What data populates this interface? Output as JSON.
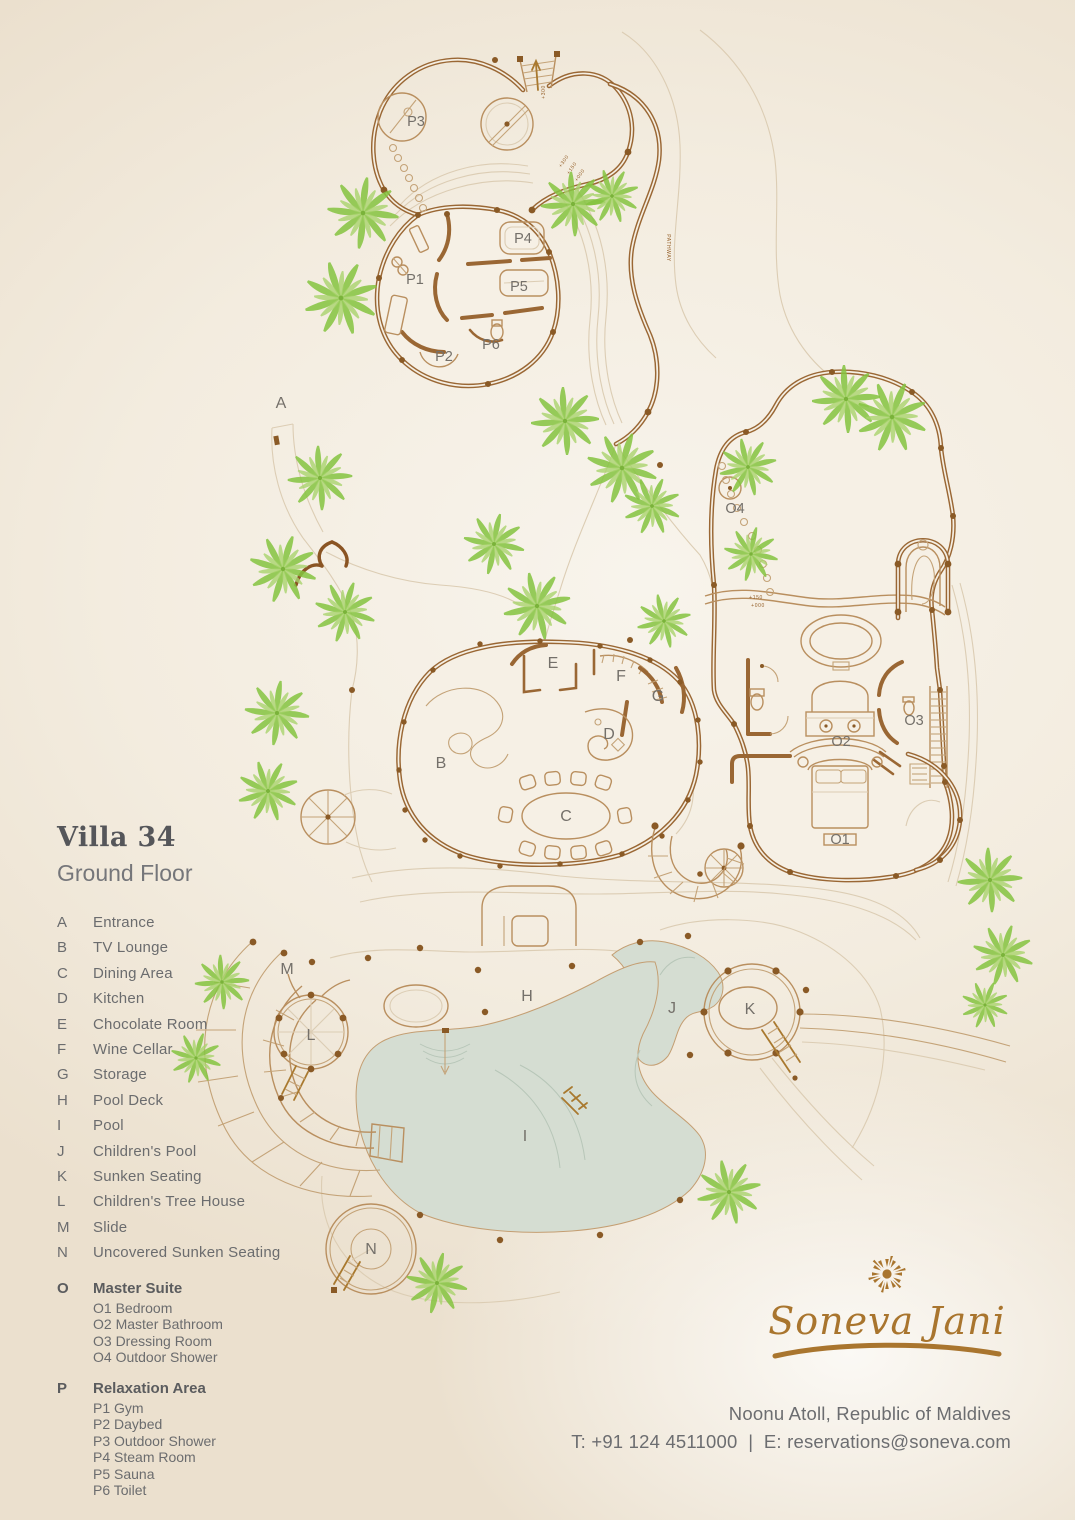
{
  "header": {
    "title": "Villa 34",
    "subtitle": "Ground Floor"
  },
  "legend": {
    "items": [
      {
        "key": "A",
        "label": "Entrance"
      },
      {
        "key": "B",
        "label": "TV Lounge"
      },
      {
        "key": "C",
        "label": "Dining Area"
      },
      {
        "key": "D",
        "label": "Kitchen"
      },
      {
        "key": "E",
        "label": "Chocolate Room"
      },
      {
        "key": "F",
        "label": "Wine Cellar"
      },
      {
        "key": "G",
        "label": "Storage"
      },
      {
        "key": "H",
        "label": "Pool Deck"
      },
      {
        "key": "I",
        "label": "Pool"
      },
      {
        "key": "J",
        "label": "Children's Pool"
      },
      {
        "key": "K",
        "label": "Sunken Seating"
      },
      {
        "key": "L",
        "label": "Children's Tree House"
      },
      {
        "key": "M",
        "label": "Slide"
      },
      {
        "key": "N",
        "label": "Uncovered Sunken Seating"
      }
    ],
    "master_suite": {
      "key": "O",
      "label": "Master Suite",
      "items": [
        "O1 Bedroom",
        "O2 Master Bathroom",
        "O3 Dressing Room",
        "O4 Outdoor Shower"
      ]
    },
    "relaxation": {
      "key": "P",
      "label": "Relaxation Area",
      "items": [
        "P1 Gym",
        "P2 Daybed",
        "P3 Outdoor Shower",
        "P4 Steam Room",
        "P5 Sauna",
        "P6 Toilet"
      ]
    }
  },
  "plan": {
    "labels": [
      "A",
      "B",
      "C",
      "D",
      "E",
      "F",
      "G",
      "H",
      "I",
      "J",
      "K",
      "L",
      "M",
      "N",
      "O1",
      "O2",
      "O3",
      "O4",
      "P1",
      "P2",
      "P3",
      "P4",
      "P5",
      "P6"
    ],
    "pathway": "PATHWAY",
    "markers": [
      "+300",
      "+300",
      "+150",
      "+000",
      "+150",
      "+000"
    ]
  },
  "footer": {
    "brand": "Soneva Jani",
    "location": "Noonu Atoll, Republic of Maldives",
    "phone": "T: +91 124 4511000",
    "separator": "|",
    "email": "E: reservations@soneva.com"
  },
  "colors": {
    "wall_brown": "#9a6734",
    "detail_brown": "#bf9a6e",
    "palm_green": "#8dc63f",
    "palm_green_light": "#aad46e",
    "pool_water": "#d5ddd2",
    "background_cream": "#f3ecdf",
    "text_gray": "#6b6c6e",
    "title_gray": "#55565a",
    "brand_gold": "#a9752e"
  }
}
